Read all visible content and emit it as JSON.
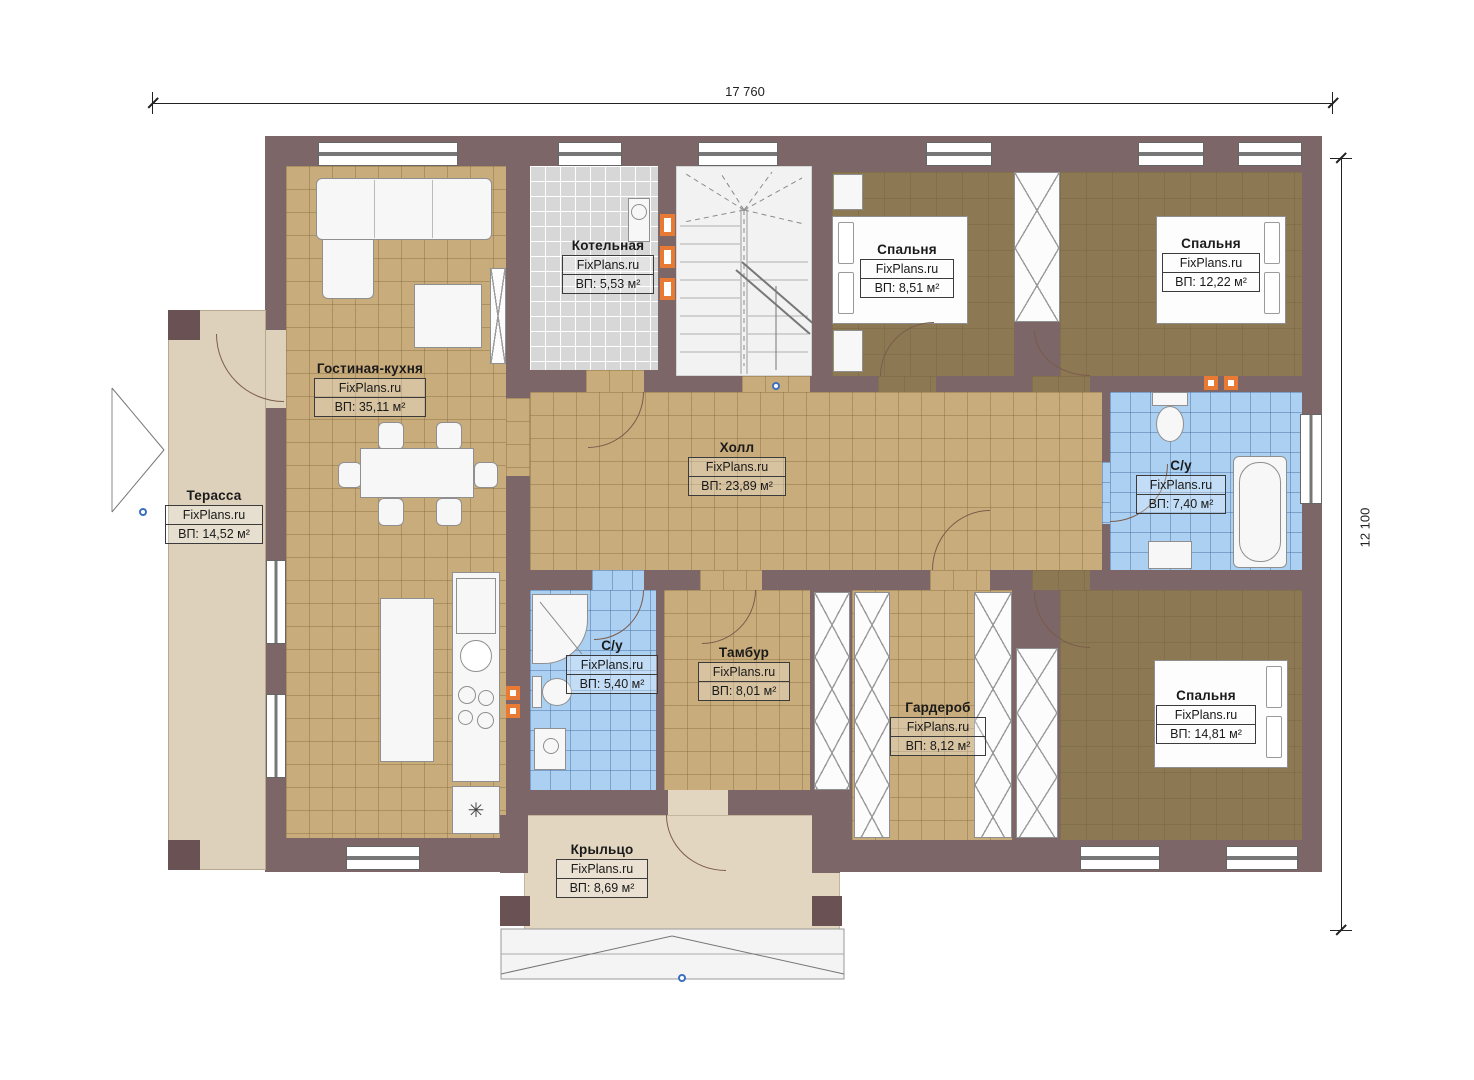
{
  "brand": "FixPlans.ru",
  "dimensions": {
    "top": "17 760",
    "right": "12 100"
  },
  "rooms": [
    {
      "name": "Гостиная-кухня",
      "area": "ВП: 35,11 м²"
    },
    {
      "name": "Котельная",
      "area": "ВП: 5,53 м²"
    },
    {
      "name": "Спальня",
      "area": "ВП: 8,51 м²"
    },
    {
      "name": "Спальня",
      "area": "ВП: 12,22 м²"
    },
    {
      "name": "Холл",
      "area": "ВП: 23,89 м²"
    },
    {
      "name": "С/у",
      "area": "ВП: 7,40 м²"
    },
    {
      "name": "Терасса",
      "area": "ВП: 14,52 м²"
    },
    {
      "name": "С/у",
      "area": "ВП: 5,40 м²"
    },
    {
      "name": "Тамбур",
      "area": "ВП: 8,01 м²"
    },
    {
      "name": "Гардероб",
      "area": "ВП: 8,12 м²"
    },
    {
      "name": "Спальня",
      "area": "ВП: 14,81 м²"
    },
    {
      "name": "Крыльцо",
      "area": "ВП: 8,69 м²"
    }
  ],
  "icons": {
    "fridge_snowflake": "✳"
  },
  "colors": {
    "wall": "#7c6667",
    "floor_tan": "#c9ac7c",
    "floor_bedroom": "#8c7852",
    "floor_bath": "#abd0f2",
    "floor_boiler": "#d7d7d7",
    "floor_terrace": "#ddd1bc",
    "vent_accent": "#e87a33"
  }
}
